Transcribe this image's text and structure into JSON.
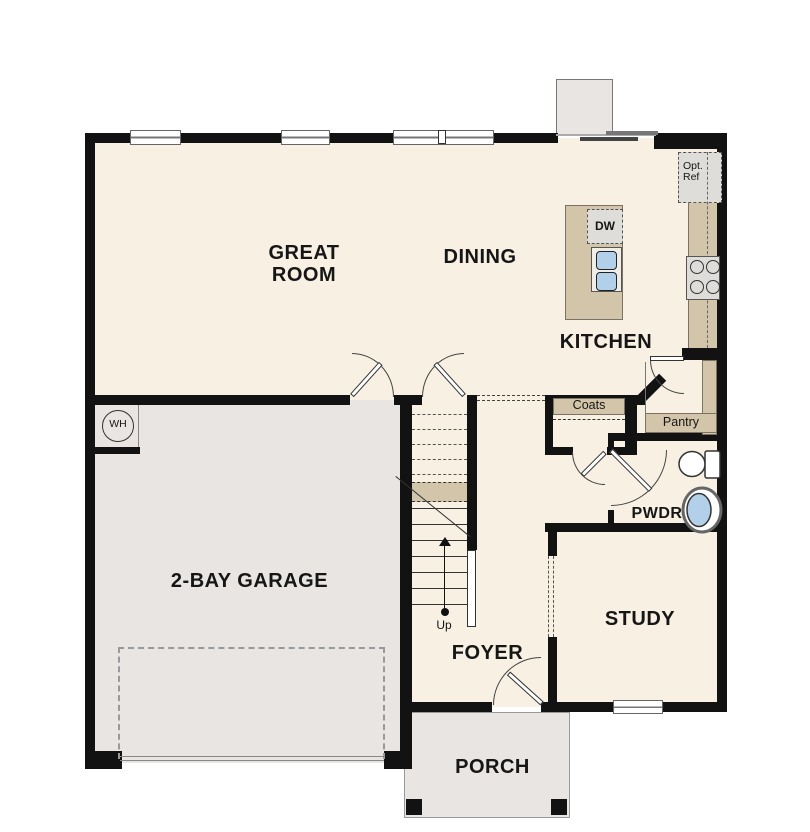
{
  "title": "First floor plan",
  "colors": {
    "wall": "#121212",
    "floor": "#f7f0e3",
    "garage_floor": "#e8e5e2",
    "cabinetry": "#d3c5a9",
    "appliance": "#dfddd9",
    "fixture_blue": "#b3d0eb"
  },
  "rooms": {
    "great_room": "GREAT\nROOM",
    "dining": "DINING",
    "kitchen": "KITCHEN",
    "garage": "2-BAY GARAGE",
    "foyer": "FOYER",
    "study": "STUDY",
    "powder": "PWDR",
    "porch": "PORCH"
  },
  "features": {
    "coats_closet": "Coats",
    "pantry": "Pantry",
    "dishwasher": "DW",
    "optional_refrigerator": "Opt.\nRef",
    "water_heater": "WH",
    "stairs_direction": "Up"
  }
}
